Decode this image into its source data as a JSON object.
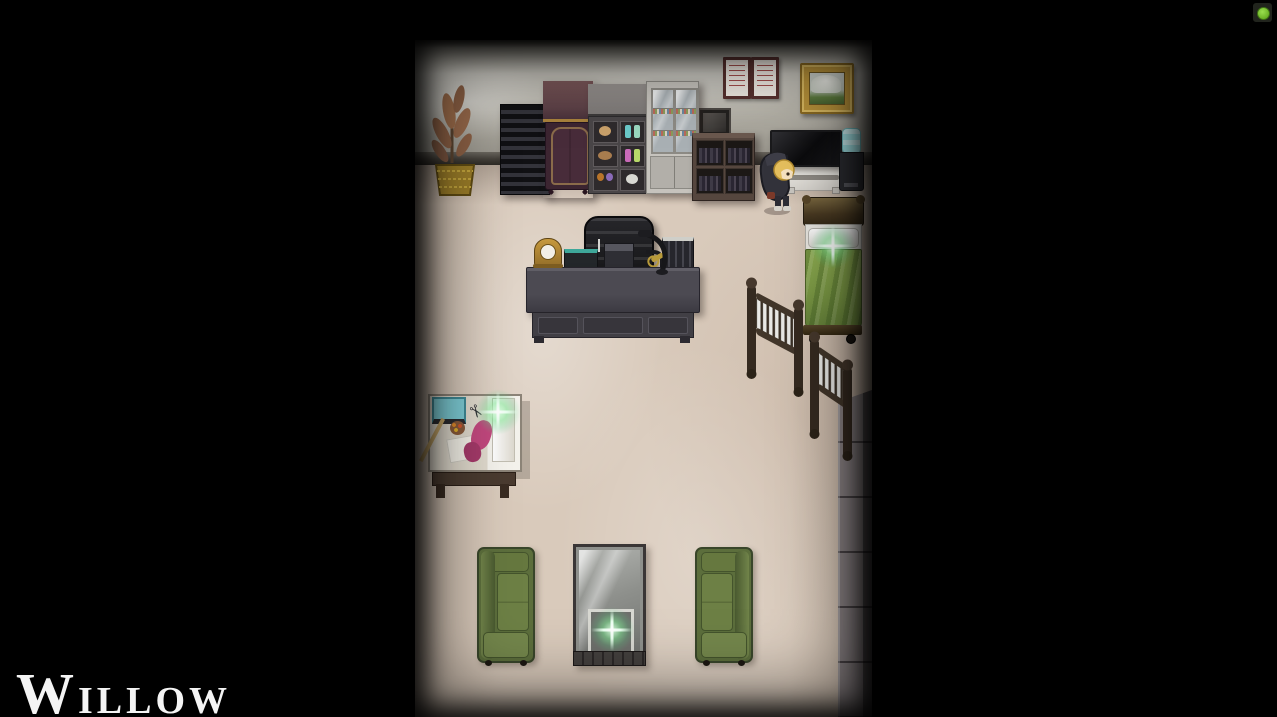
{
  "hud": {
    "location_title": {
      "initial": "W",
      "rest": "ILLOW",
      "full": "WILLOW"
    },
    "recording_indicator": {
      "dot_color": "#74c12d",
      "box_color": "#21241d"
    }
  },
  "scene": {
    "type": "top-down-rpg-room",
    "palette": {
      "background": "#000000",
      "floor": "#d9cabb",
      "wall": "#b5b2a8",
      "baseboard": "#433f39",
      "sparkle_glow": "#82eb96",
      "couch_green": "#5c6e3c",
      "bed_blanket_green": "#7c9a45",
      "stone_gray": "#8b8385",
      "wood_dark": "#3a2e24",
      "wardrobe_plum": "#3c2531",
      "frame_gold": "#b8923a",
      "water_bottle_cyan": "#9fdfe2",
      "fabric_pink": "#c2487e",
      "sewing_machine_teal": "#7ecdd6"
    },
    "objects": [
      {
        "name": "potted-plant",
        "interactable": false
      },
      {
        "name": "slatted-shelf",
        "interactable": false
      },
      {
        "name": "wardrobe",
        "interactable": false
      },
      {
        "name": "display-case",
        "interactable": false
      },
      {
        "name": "glass-cabinet",
        "interactable": false
      },
      {
        "name": "wall-display-box",
        "interactable": false
      },
      {
        "name": "bookshelf",
        "interactable": false
      },
      {
        "name": "framed-certificate",
        "count": 2,
        "interactable": false
      },
      {
        "name": "gold-framed-painting",
        "interactable": false
      },
      {
        "name": "tv-with-console",
        "interactable": false
      },
      {
        "name": "water-cooler",
        "interactable": false
      },
      {
        "name": "player-character",
        "interactable": true
      },
      {
        "name": "bed",
        "has_sparkle": true,
        "interactable": true
      },
      {
        "name": "office-chair",
        "interactable": false
      },
      {
        "name": "office-desk",
        "interactable": false
      },
      {
        "name": "stair-railing",
        "count": 2,
        "interactable": false
      },
      {
        "name": "stairwell-column",
        "interactable": false
      },
      {
        "name": "sewing-table",
        "has_sparkle": true,
        "interactable": true
      },
      {
        "name": "couch",
        "count": 2,
        "interactable": false
      },
      {
        "name": "glass-coffee-table",
        "has_sparkle": true,
        "interactable": true
      }
    ]
  }
}
